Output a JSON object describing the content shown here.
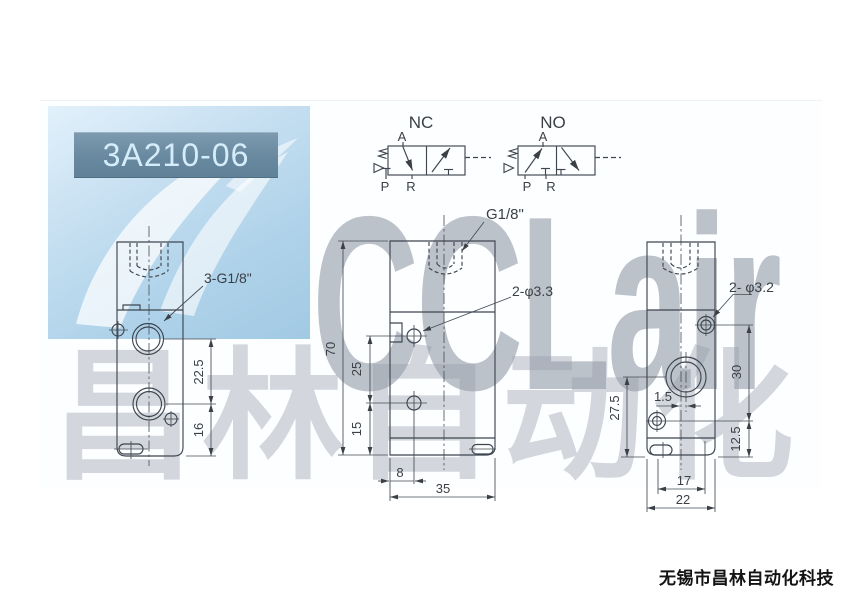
{
  "page": {
    "model": "3A210-06",
    "brand_watermark": "CCLair",
    "cn_watermark": "昌林自动化",
    "footer_company": "无锡市昌林自动化科技"
  },
  "symbols": {
    "nc": {
      "title": "NC"
    },
    "no": {
      "title": "NO"
    },
    "ports": {
      "a": "A",
      "p": "P",
      "r": "R"
    }
  },
  "views": {
    "front": {
      "thread_label": "3-G1/8\"",
      "dim_port_spacing": "22.5",
      "dim_port_bottom": "16"
    },
    "side": {
      "thread_label": "G1/8\"",
      "hole_label": "2-φ3.3",
      "dim_height": "70",
      "dim_hole_spacing": "25",
      "dim_hole_bottom": "15",
      "dim_hole_left": "8",
      "dim_width": "35"
    },
    "end": {
      "hole_label": "2- φ3.2",
      "dim_hole_spacing": "30",
      "dim_offset": "1.5",
      "dim_port_bottom": "27.5",
      "dim_hole_bottom": "12.5",
      "dim_slot_spacing": "17",
      "dim_width": "22"
    }
  },
  "colors": {
    "line": "#3e4650",
    "title_bg": "#68899f",
    "title_text": "#d5edfb",
    "logo_bg": "#aed2e9",
    "watermark": "#8d99a8"
  }
}
